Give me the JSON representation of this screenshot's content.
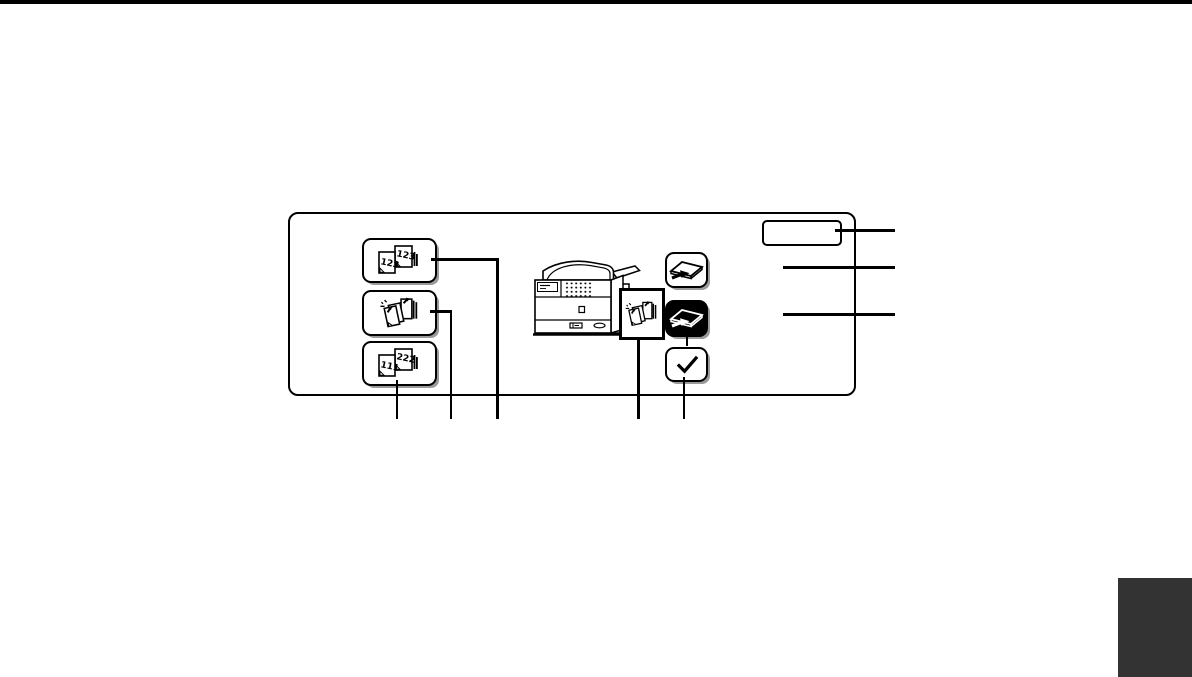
{
  "page": {
    "background": "#ffffff",
    "top_bar_color": "#000000",
    "corner_tab_color": "#333333"
  },
  "diagram": {
    "panel": {
      "border_color": "#000000",
      "background": "#ffffff"
    },
    "label_box": {
      "text": ""
    },
    "keys": {
      "sort": {
        "icon": "sort-pages-icon",
        "page_text_back": "123",
        "page_text_front": "123"
      },
      "staple_sort": {
        "icon": "staple-sort-icon"
      },
      "group": {
        "icon": "group-pages-icon",
        "page_text_back": "222",
        "page_text_front": "111"
      },
      "offset": {
        "icon": "offset-tray-icon",
        "inverted": false
      },
      "offset_selected": {
        "icon": "offset-tray-icon",
        "inverted": true
      },
      "ok": {
        "icon": "check-icon"
      }
    },
    "illustration": {
      "subject": "copier-with-finisher",
      "overlay_icon": "staple-sort-icon"
    }
  }
}
